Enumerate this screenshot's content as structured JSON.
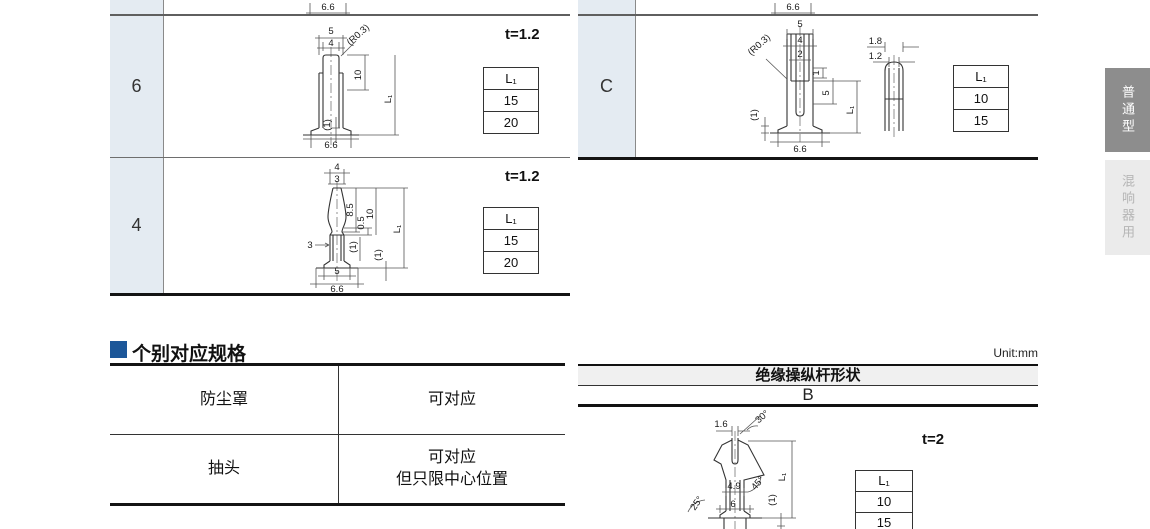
{
  "page": {
    "unit_label": "Unit:mm"
  },
  "top_fragments": {
    "left_dim": "6.6",
    "right_dim": "6.6"
  },
  "terminal_table_left": {
    "rows": [
      {
        "label": "6",
        "thickness": "t=1.2",
        "l1_table": {
          "header": "L₁",
          "values": [
            "15",
            "20"
          ]
        },
        "dims": {
          "w1": "5",
          "w2": "4",
          "r": "(R0.3)",
          "h1": "10",
          "l1": "L₁",
          "p1": "(1)",
          "base": "6.6"
        }
      },
      {
        "label": "4",
        "thickness": "t=1.2",
        "l1_table": {
          "header": "L₁",
          "values": [
            "15",
            "20"
          ]
        },
        "dims": {
          "w1": "4",
          "w2": "3",
          "left": "3",
          "h1": "8.5",
          "h2": "0.5",
          "h3": "10",
          "p1": "(1)",
          "l1": "L₁",
          "p2": "(1)",
          "b1": "5",
          "b2": "6.6"
        }
      }
    ]
  },
  "terminal_table_right": {
    "rows": [
      {
        "label": "C",
        "l1_table": {
          "header": "L₁",
          "values": [
            "10",
            "15"
          ]
        },
        "dims": {
          "w1": "5",
          "w2": "4",
          "w3": "2",
          "r": "(R0.3)",
          "n1": "1",
          "n2": "5",
          "l1": "L₁",
          "p1": "(1)",
          "base": "6.6",
          "s1": "1.8",
          "s2": "1.2"
        }
      }
    ]
  },
  "side_tabs": [
    {
      "label": "普通型"
    },
    {
      "label": "混响器用"
    }
  ],
  "spec_section": {
    "title": "个别对应规格",
    "rows": [
      {
        "name": "防尘罩",
        "value": "可对应"
      },
      {
        "name": "抽头",
        "value": "可对应\n但只限中心位置"
      }
    ]
  },
  "lever_section": {
    "header": "绝缘操纵杆形状",
    "variant": "B",
    "thickness": "t=2",
    "l1_table": {
      "header": "L₁",
      "values": [
        "10",
        "15"
      ]
    },
    "dims": {
      "a1": "30°",
      "w1": "1.6",
      "w2": "4.9",
      "a2": "45°",
      "a3": "25°",
      "w3": "6",
      "l1": "L₁",
      "p1": "(1)"
    }
  },
  "colors": {
    "accent_blue": "#1c5799",
    "label_cell": "#e4ebf2",
    "tab_dark": "#8d8d8d",
    "tab_light": "#ebebeb",
    "header_bar": "#f0f0f0"
  }
}
